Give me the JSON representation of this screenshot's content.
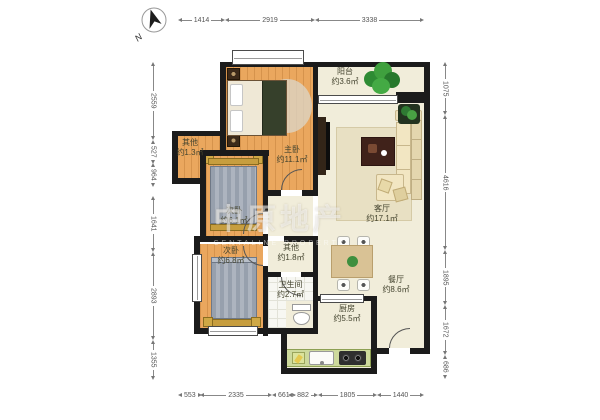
{
  "compass": {
    "label": "N"
  },
  "watermark": {
    "cn": "中原地产",
    "en": "CENTALINE PROPERTY"
  },
  "rooms": [
    {
      "id": "master-bedroom",
      "name": "主卧",
      "area": "约11.1㎡"
    },
    {
      "id": "second-bedroom-a",
      "name": "次卧",
      "area": "约6.1㎡"
    },
    {
      "id": "second-bedroom-b",
      "name": "次卧",
      "area": "约6.8㎡"
    },
    {
      "id": "other-a",
      "name": "其他",
      "area": "约1.3㎡"
    },
    {
      "id": "other-b",
      "name": "其他",
      "area": "约1.8㎡"
    },
    {
      "id": "bathroom",
      "name": "卫生间",
      "area": "约2.7㎡"
    },
    {
      "id": "kitchen",
      "name": "厨房",
      "area": "约5.5㎡"
    },
    {
      "id": "dining-room",
      "name": "餐厅",
      "area": "约8.6㎡"
    },
    {
      "id": "living-room",
      "name": "客厅",
      "area": "约17.1㎡"
    },
    {
      "id": "balcony",
      "name": "阳台",
      "area": "约3.6㎡"
    }
  ],
  "dimensions": {
    "top": [
      "1414",
      "2919",
      "3338"
    ],
    "bottom": [
      "553",
      "2335",
      "661",
      "882",
      "1805",
      "1440"
    ],
    "left": [
      "2559",
      "527",
      "964",
      "1641",
      "2893",
      "1355"
    ],
    "right": [
      "1075",
      "4616",
      "1895",
      "1672",
      "686"
    ]
  },
  "colors": {
    "wall": "#1b1b1b",
    "wood_floor": "#eaa75e",
    "cream_floor": "#f1edda",
    "tile_floor": "#f7f7f2",
    "kitchen_counter": "#cdd99c",
    "plant_green": "#3e9b3b",
    "bed_blanket_gray": "#9aa2ae",
    "bed_frame_gold": "#cfa845",
    "sofa_cream": "#f2e6c2"
  }
}
